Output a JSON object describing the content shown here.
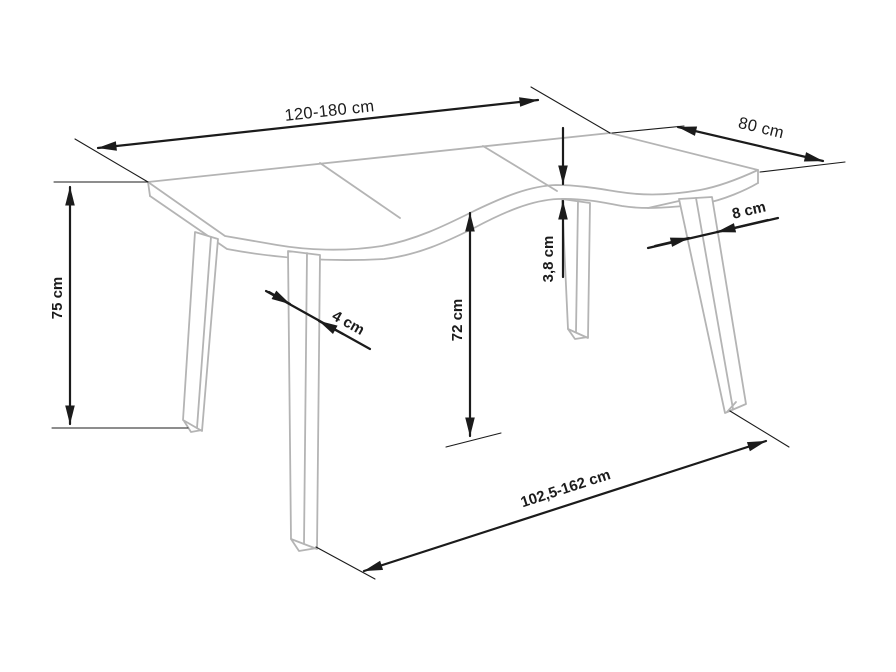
{
  "diagram": {
    "kind": "furniture-dimension-drawing",
    "subject": "extendable dining table with four splayed legs and wavy table top edge",
    "colors": {
      "background": "#ffffff",
      "furniture_outline": "#b4b4b4",
      "dimension_ink": "#1b1b1b"
    },
    "labels": {
      "top_length": "120-180 cm",
      "top_depth": "80 cm",
      "table_height": "75 cm",
      "underside_clearance": "72 cm",
      "top_thickness": "3,8 cm",
      "front_left_leg_width": "4 cm",
      "front_right_leg_width": "8 cm",
      "base_span": "102,5-162 cm"
    }
  }
}
